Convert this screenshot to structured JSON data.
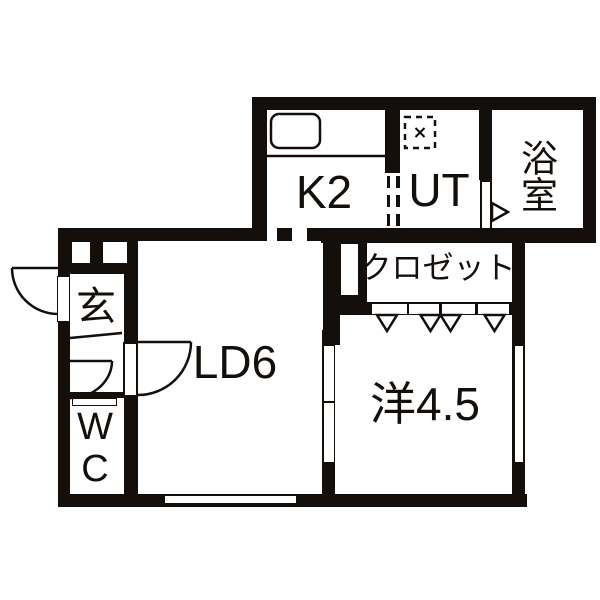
{
  "floorplan": {
    "title": "1LDK apartment floor plan",
    "colors": {
      "wall": "#150f0b",
      "floor": "#ffffff"
    },
    "rooms": {
      "kitchen": {
        "label": "K2"
      },
      "utility": {
        "label": "UT"
      },
      "bathroom": {
        "label": "浴室"
      },
      "closet": {
        "label": "クロゼット"
      },
      "living_dining": {
        "label": "LD6"
      },
      "western_room": {
        "label": "洋4.5"
      },
      "entrance": {
        "label": "玄"
      },
      "toilet": {
        "label": "WC"
      }
    },
    "symbols": {
      "sink": "kitchen-sink",
      "washer": "washing-machine-space",
      "fold_door": "closet-folding-door-triangles",
      "swing_door": "hinged-door-arc",
      "dashed_opening": "open-passage"
    }
  }
}
